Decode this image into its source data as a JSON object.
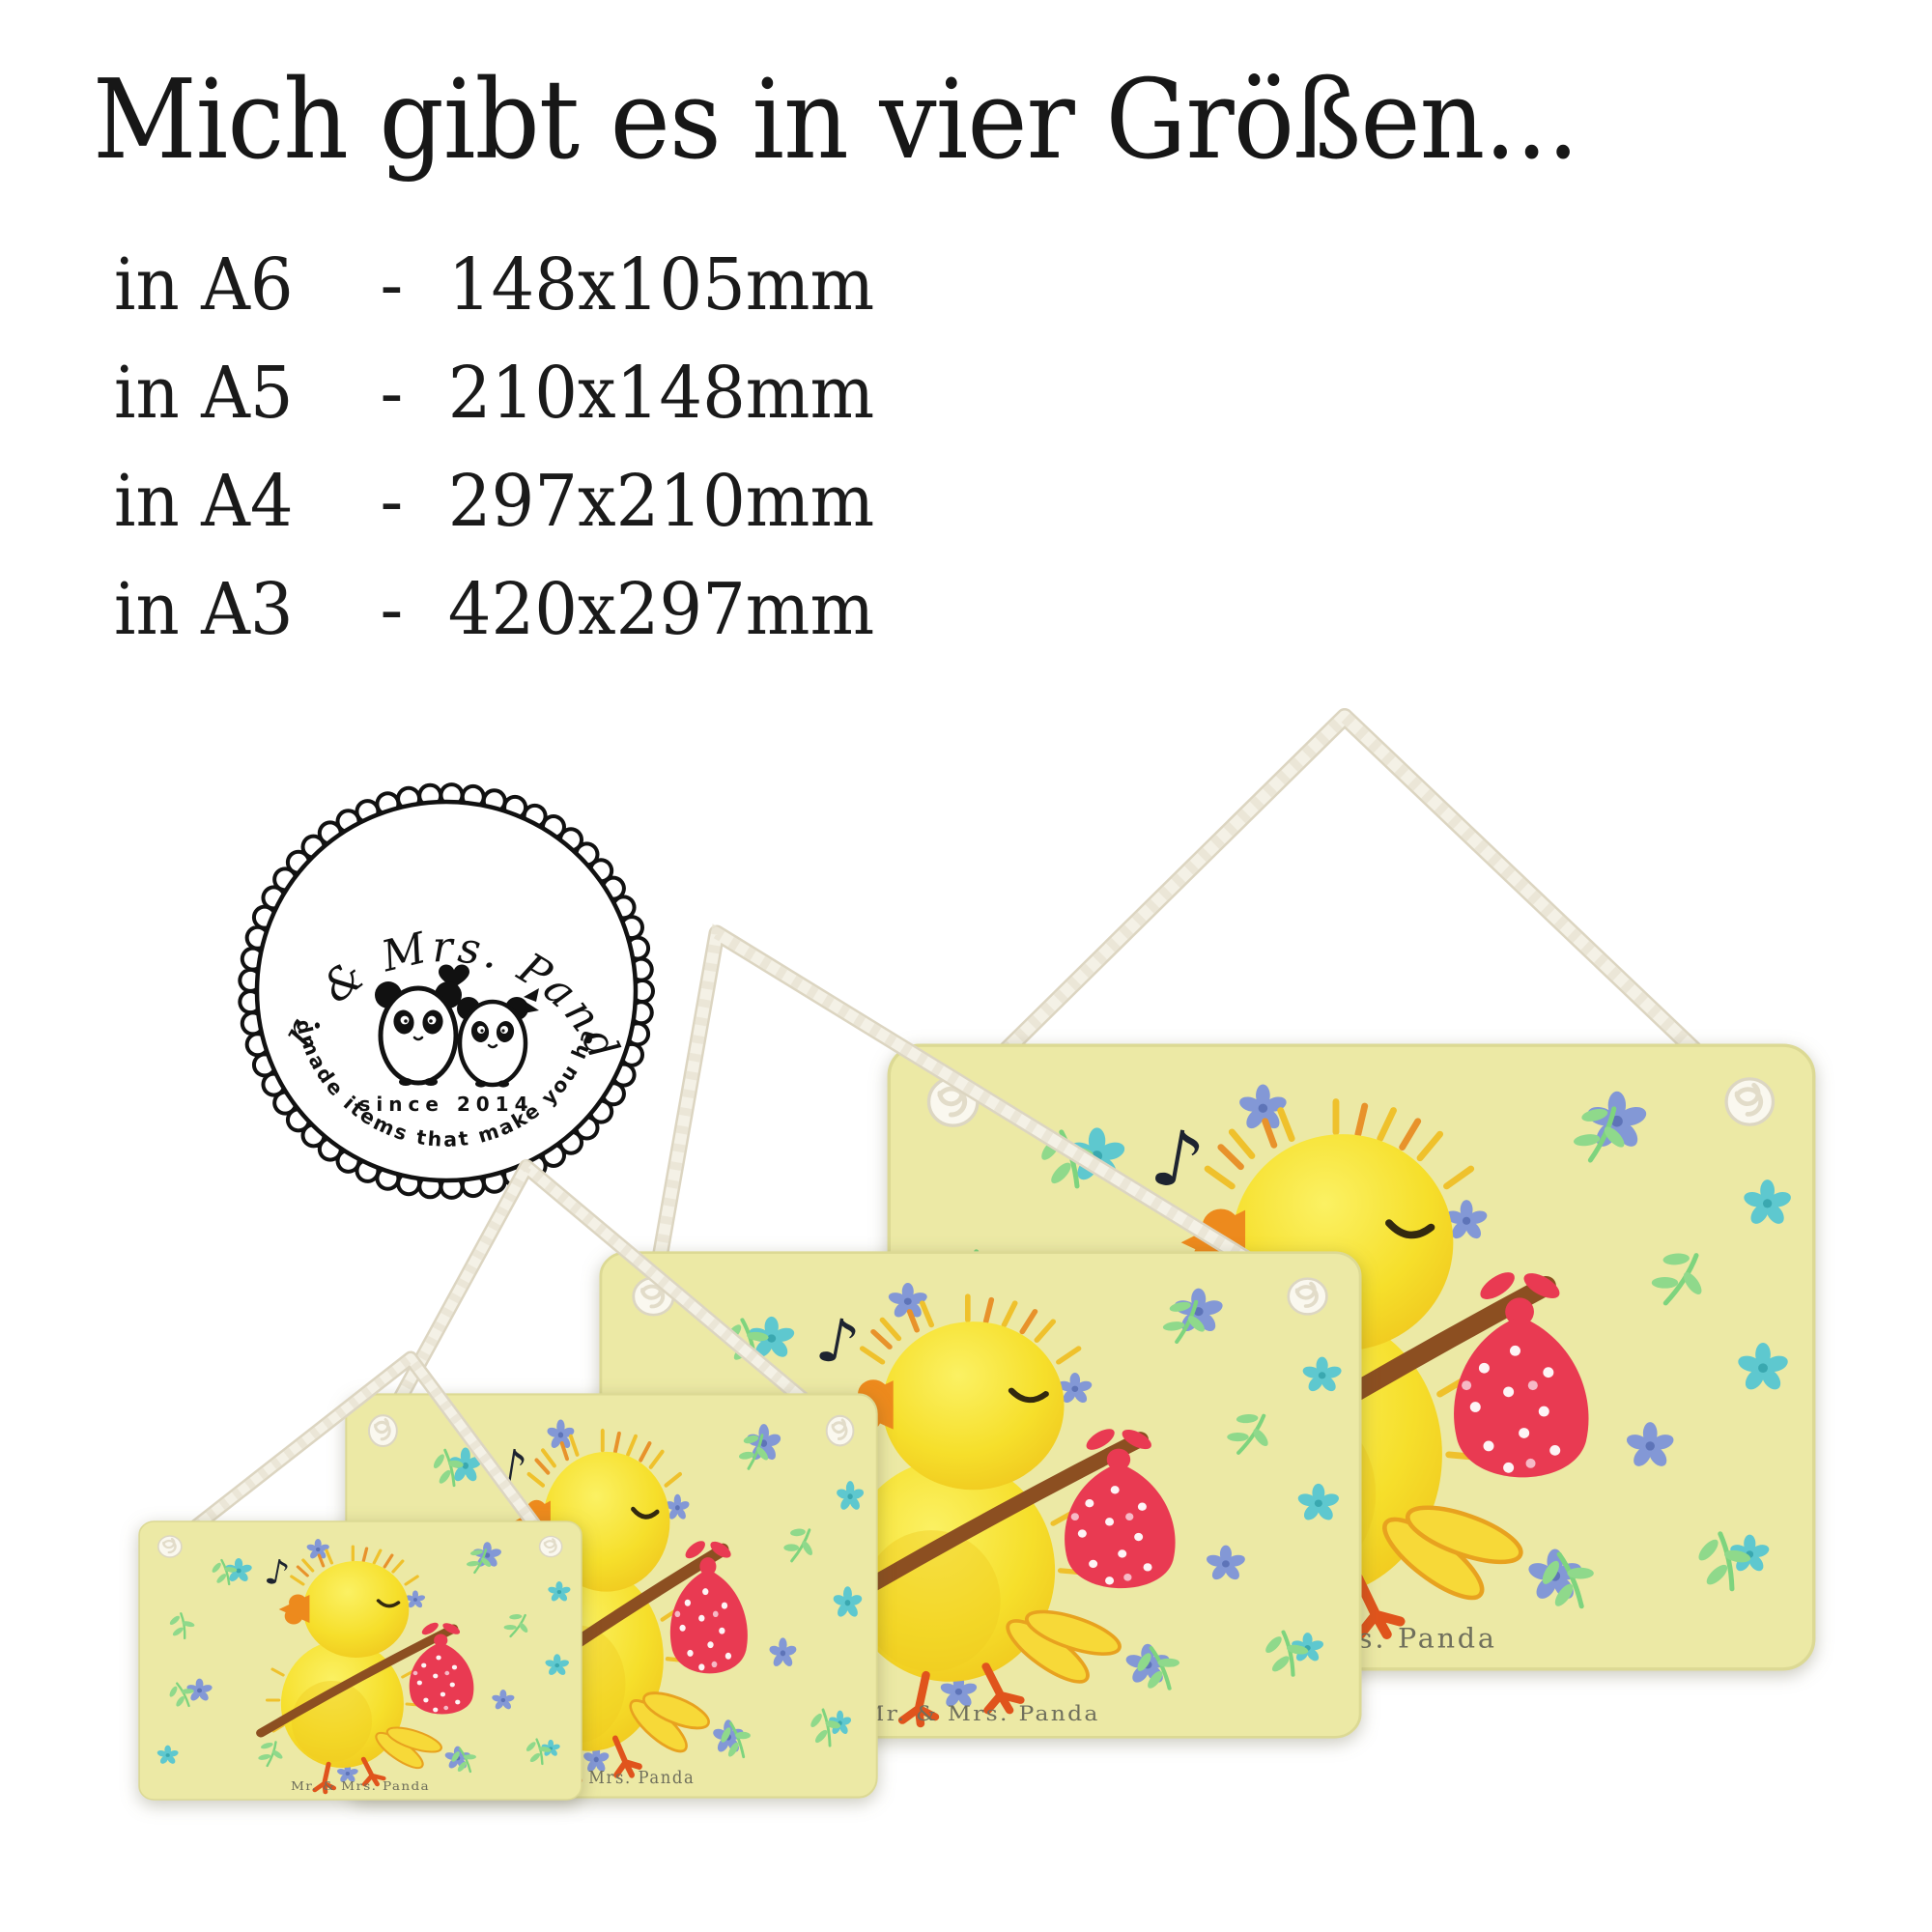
{
  "page": {
    "title": "Mich gibt es in vier Größen..."
  },
  "size_list": [
    {
      "label": "in A6",
      "separator": "-",
      "dimensions": "148x105mm"
    },
    {
      "label": "in A5",
      "separator": "-",
      "dimensions": "210x148mm"
    },
    {
      "label": "in A4",
      "separator": "-",
      "dimensions": "297x210mm"
    },
    {
      "label": "in A3",
      "separator": "-",
      "dimensions": "420x297mm"
    }
  ],
  "badge": {
    "brand": "Mr. & Mrs. Panda",
    "since": "since 2014",
    "tagline": "Handmade items that make you happy!"
  },
  "sign": {
    "watermark": "Mr. & Mrs. Panda",
    "music_note": "♪"
  },
  "colors": {
    "headline_text": "#171717",
    "sign_background": "#ECE9A5",
    "chick_yellow": "#F6DF2B",
    "beak_orange": "#ED8A1D",
    "feet_orange": "#E0541C",
    "stick_brown": "#8C4F21",
    "bundle_red": "#E93A52",
    "rope_white": "#F4F1E6",
    "flower_blue": "#8398D6",
    "flower_cyan": "#5EC8CF",
    "leaf_green": "#7ED47E",
    "badge_ink": "#111111"
  }
}
